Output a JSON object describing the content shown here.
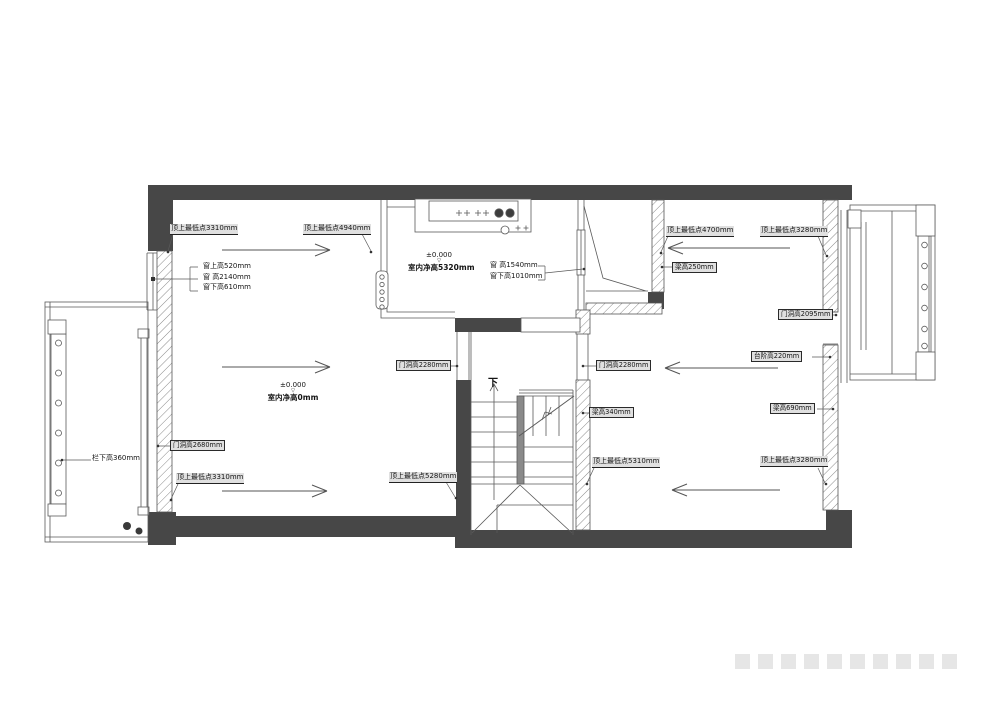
{
  "drawing_type": "residential floor plan with ceiling/opening height annotations",
  "colors": {
    "wall_dark": "#474747",
    "line": "#5a5a5a",
    "hatch_line": "#8a8a8a",
    "label_bg": "#e0e0e0"
  },
  "labels": {
    "ceiling_tl": "顶上最低点3310mm",
    "ceiling_kitchen": "顶上最低点4940mm",
    "win_left_1": "窗上高520mm",
    "win_left_2": "窗 高2140mm",
    "win_left_3": "窗下高610mm",
    "level_kitchen": "±0.000",
    "height_kitchen": "室内净高5320mm",
    "win_entry_1": "窗 高1540mm",
    "win_entry_2": "窗下高1010mm",
    "ceiling_entry": "顶上最低点4700mm",
    "ceiling_tr": "顶上最低点3280mm",
    "beam_250": "梁高250mm",
    "door_2095": "门洞高2095mm",
    "step_220": "台阶高220mm",
    "beam_690": "梁高690mm",
    "door_2280_l": "门洞高2280mm",
    "door_2280_r": "门洞高2280mm",
    "beam_340": "梁高340mm",
    "level_living": "±0.000",
    "height_living": "室内净高0mm",
    "down": "下",
    "ceiling_stair_r": "顶上最低点5310mm",
    "ceiling_stair_l": "顶上最低点5280mm",
    "ceiling_bl": "顶上最低点3310mm",
    "door_2680": "门洞高2680mm",
    "rail_360": "栏下高360mm",
    "ceiling_br": "顶上最低点3280mm",
    "level_mark": "▽"
  }
}
